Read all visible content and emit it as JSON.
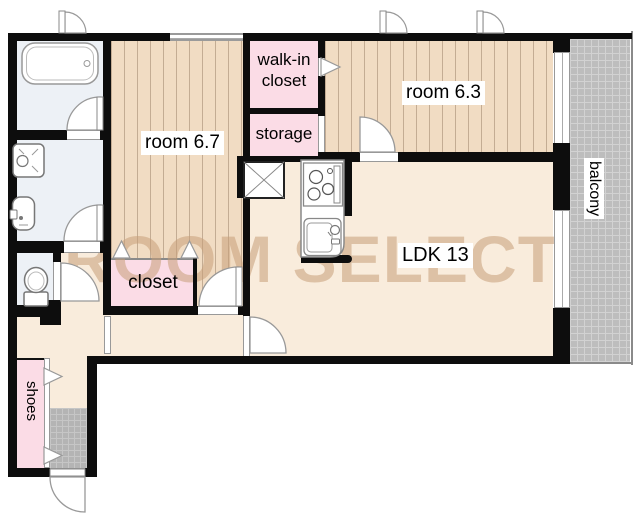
{
  "floorplan": {
    "watermark": "ROOM SELECT",
    "labels": {
      "room67": "room 6.7",
      "room63": "room 6.3",
      "walkin_closet": "walk-in closet",
      "storage": "storage",
      "closet": "closet",
      "ldk": "LDK 13",
      "balcony": "balcony",
      "shoes": "shoes"
    },
    "colors": {
      "wall": "#0d0d0d",
      "wood_floor": "#f1dcc3",
      "living_floor": "#f9ecdc",
      "closet_pink": "#fbdce6",
      "wet_area_floor": "#edf1f6",
      "tile_gray": "#b4b4b4",
      "balcony_gray": "#bdbdbd",
      "watermark_tan": "#c69e78"
    }
  }
}
